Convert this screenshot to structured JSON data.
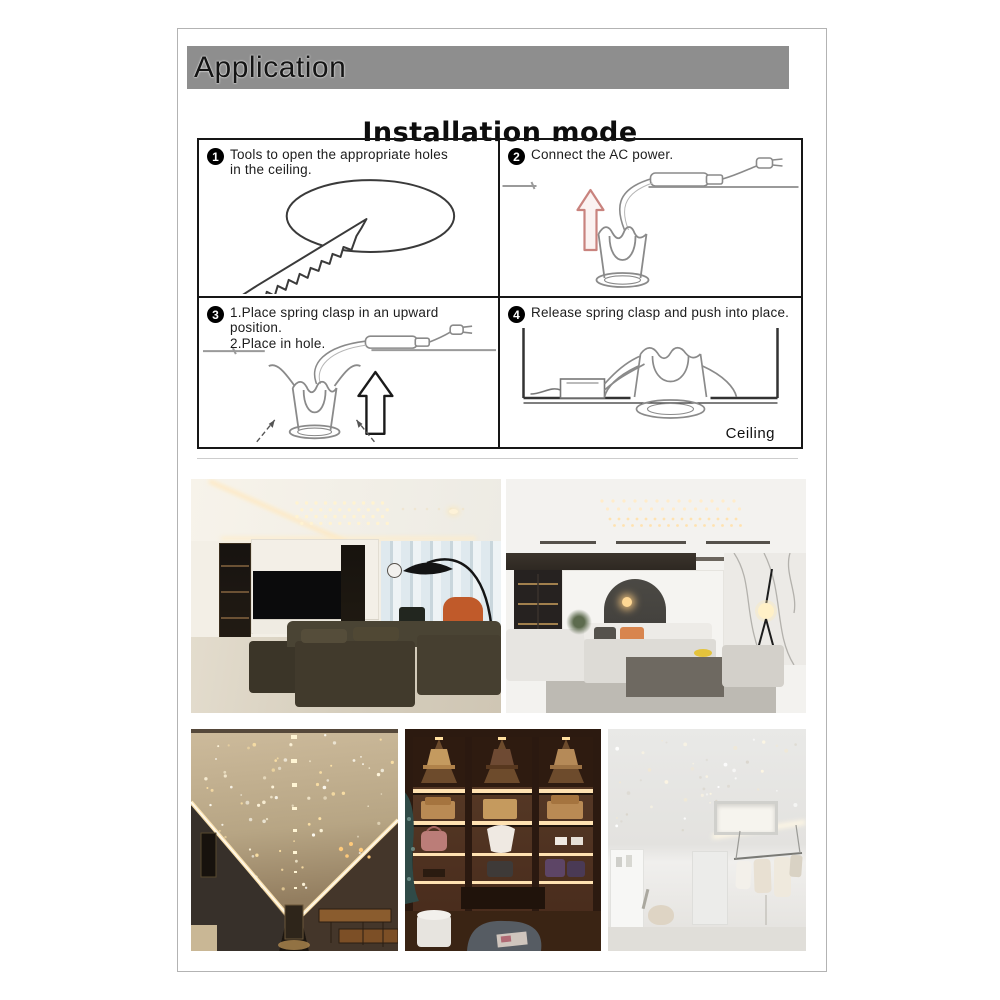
{
  "banner": {
    "label": "Application"
  },
  "title": "Installation mode",
  "steps": {
    "s1": {
      "num": "1",
      "line1": "Tools to open the appropriate holes",
      "line2": "in the ceiling."
    },
    "s2": {
      "num": "2",
      "line1": "Connect the AC power."
    },
    "s3": {
      "num": "3",
      "line1": "1.Place spring clasp in an upward position.",
      "line2": "2.Place in hole."
    },
    "s4": {
      "num": "4",
      "line1": "Release spring clasp and push into place.",
      "caption": "Ceiling"
    }
  },
  "colors": {
    "banner_bg": "#8e8e8e",
    "table_border": "#161616",
    "line_art": "#8a8a8a",
    "structure_line": "#333333",
    "accent_arrow": "#c9837e",
    "warm_light": "#ffe2ad"
  }
}
